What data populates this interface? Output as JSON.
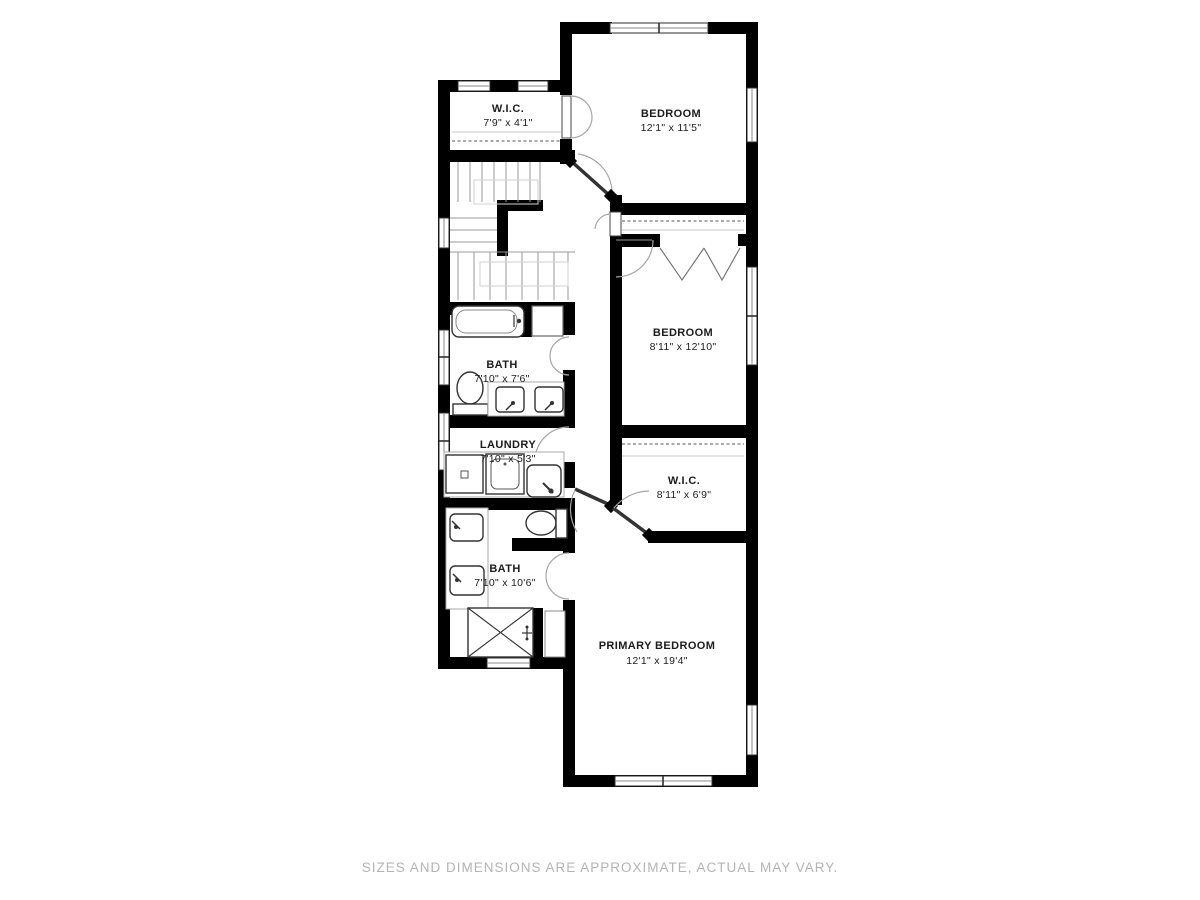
{
  "rooms": {
    "wic_upper": {
      "name": "W.I.C.",
      "dims": "7'9\" x 4'1\""
    },
    "bedroom_upper": {
      "name": "BEDROOM",
      "dims": "12'1\" x 11'5\""
    },
    "bath_upper": {
      "name": "BATH",
      "dims": "7'10\" x 7'6\""
    },
    "bedroom_middle": {
      "name": "BEDROOM",
      "dims": "8'11\" x 12'10\""
    },
    "laundry": {
      "name": "LAUNDRY",
      "dims": "7'10\" x 5'3\""
    },
    "wic_primary": {
      "name": "W.I.C.",
      "dims": "8'11\" x 6'9\""
    },
    "bath_primary": {
      "name": "BATH",
      "dims": "7'10\" x 10'6\""
    },
    "primary_bedroom": {
      "name": "PRIMARY BEDROOM",
      "dims": "12'1\" x 19'4\""
    }
  },
  "footer": {
    "disclaimer": "SIZES AND DIMENSIONS ARE APPROXIMATE, ACTUAL MAY VARY."
  },
  "colors": {
    "wall": "#000000",
    "label": "#1c1c1c",
    "muted_text": "#b4b4b4",
    "background": "#ffffff"
  },
  "icons": {
    "fixtures": [
      "bathtub-icon",
      "toilet-icon",
      "sink-icon",
      "washer-icon",
      "laundry-sink-icon",
      "shower-icon",
      "stairs-icon",
      "closet-rod-icon",
      "door-swing-icon",
      "window-icon"
    ]
  }
}
